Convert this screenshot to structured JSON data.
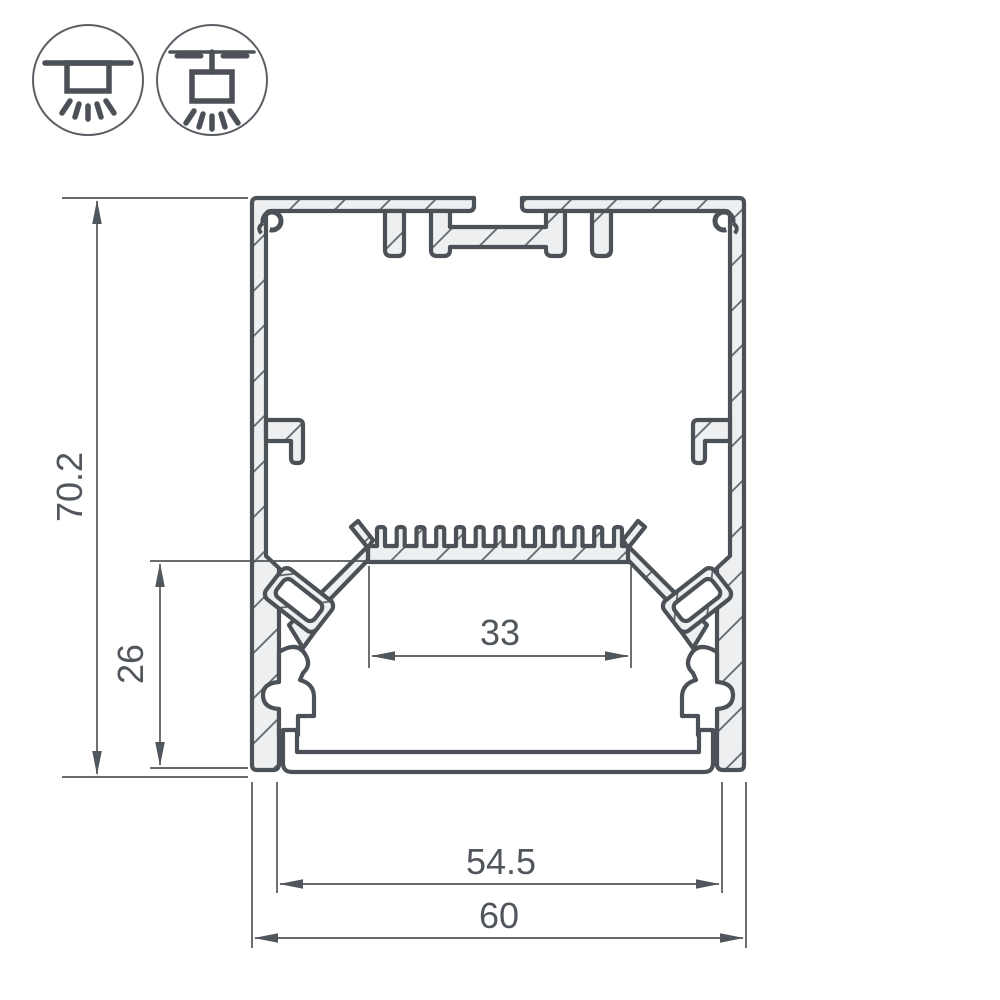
{
  "icons": {
    "surface_mount": {
      "name": "surface-mount-luminaire"
    },
    "pendant_mount": {
      "name": "pendant-mount-luminaire"
    }
  },
  "drawing": {
    "dimensions": {
      "overall_height": "70.2",
      "lower_inner_height": "26",
      "led_platform_width": "33",
      "inner_width": "54.5",
      "overall_width": "60"
    },
    "colors": {
      "line": "#4b5157",
      "aluminum_fill": "#edeff0",
      "hatch_line": "#596066",
      "dimension_line": "#50565c",
      "background": "#ffffff"
    }
  }
}
